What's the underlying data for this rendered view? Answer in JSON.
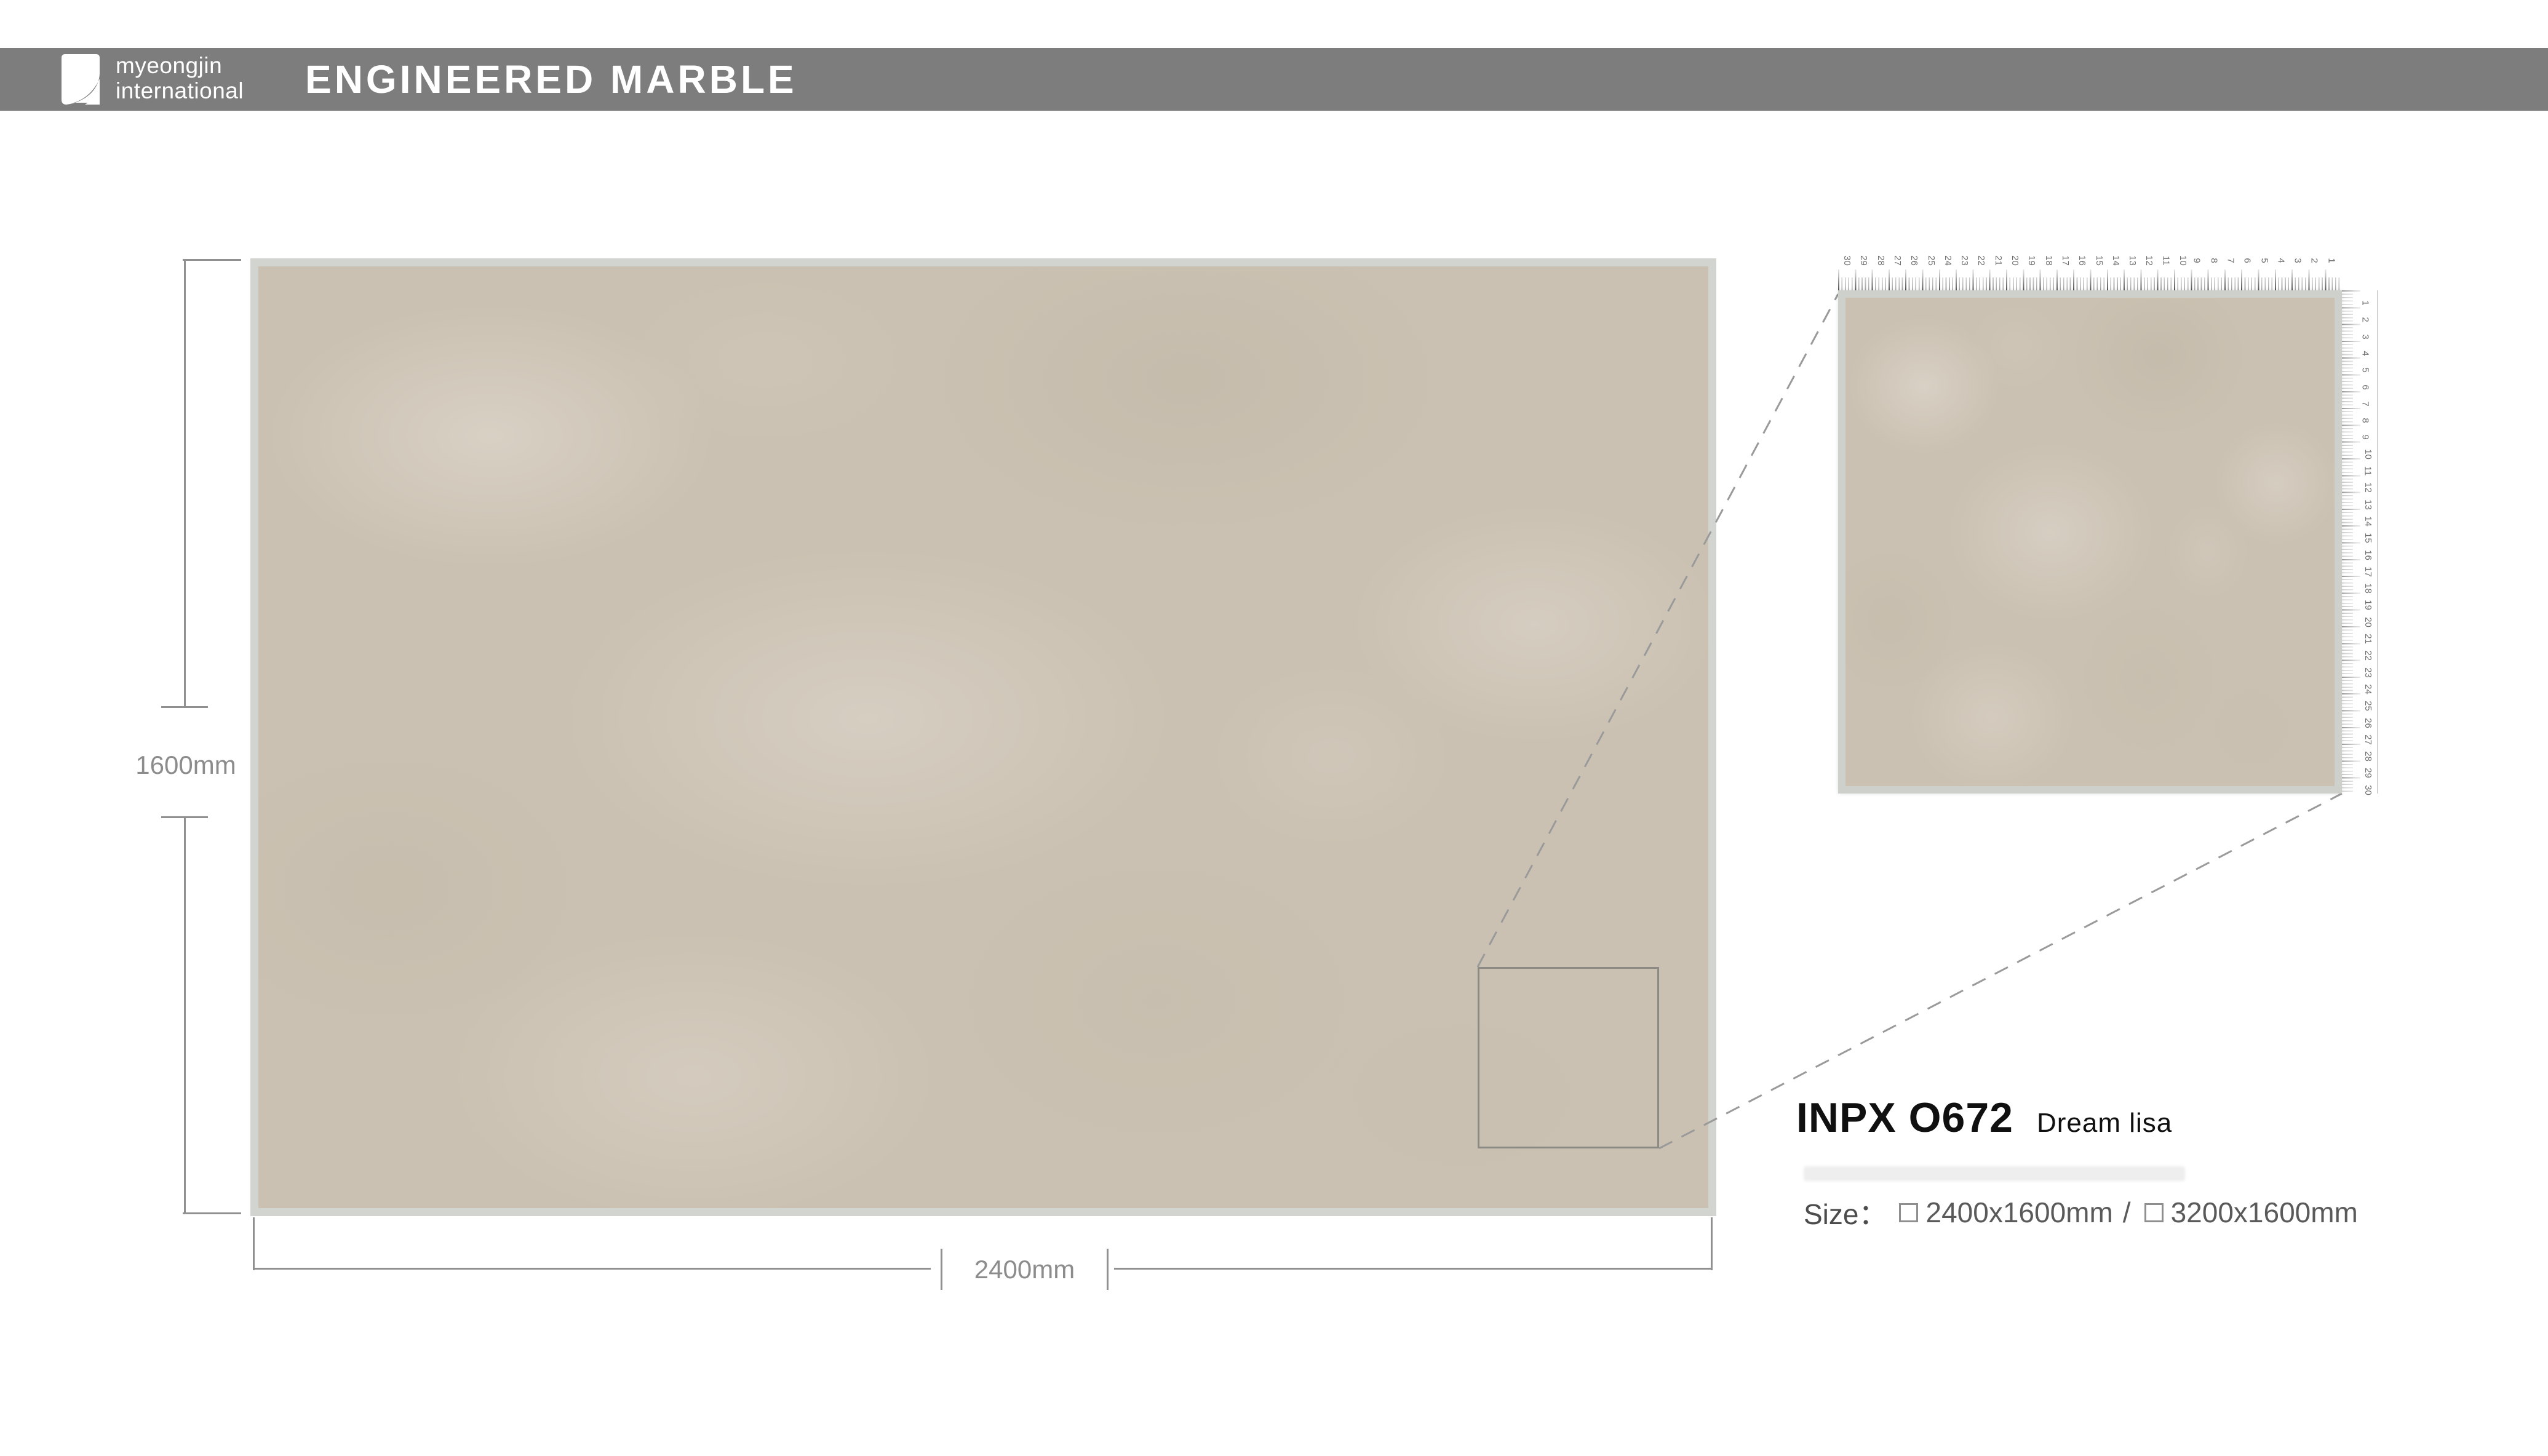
{
  "header": {
    "logo_line1": "myeongjin",
    "logo_line2": "international",
    "title": "ENGINEERED MARBLE"
  },
  "dimensions": {
    "height_label": "1600mm",
    "width_label": "2400mm"
  },
  "product": {
    "code": "INPX O672",
    "name": "Dream lisa",
    "size_label": "Size：",
    "option1": "2400x1600mm",
    "separator": "/",
    "option2": "3200x1600mm"
  },
  "detail_view": {
    "top_ruler_numbers": [
      "30",
      "29",
      "28",
      "27",
      "26",
      "25",
      "24",
      "23",
      "22",
      "21",
      "20",
      "19",
      "18",
      "17",
      "16",
      "15",
      "14",
      "13",
      "12",
      "11",
      "10",
      "9",
      "8",
      "7",
      "6",
      "5",
      "4",
      "3",
      "2",
      "1"
    ],
    "right_ruler_numbers": [
      "1",
      "2",
      "3",
      "4",
      "5",
      "6",
      "7",
      "8",
      "9",
      "10",
      "11",
      "12",
      "13",
      "14",
      "15",
      "16",
      "17",
      "18",
      "19",
      "20",
      "21",
      "22",
      "23",
      "24",
      "25",
      "26",
      "27",
      "28",
      "29",
      "30"
    ]
  },
  "colors": {
    "header_bar": "#7d7d7d",
    "marble_base": "#cbc1b2",
    "slab_border": "#d2d4d0",
    "dimension_line": "#909090",
    "dimension_text": "#8c8c8c",
    "dashed_line": "#9a9a9a",
    "product_text": "#101010",
    "size_text": "#5a5a5a"
  }
}
